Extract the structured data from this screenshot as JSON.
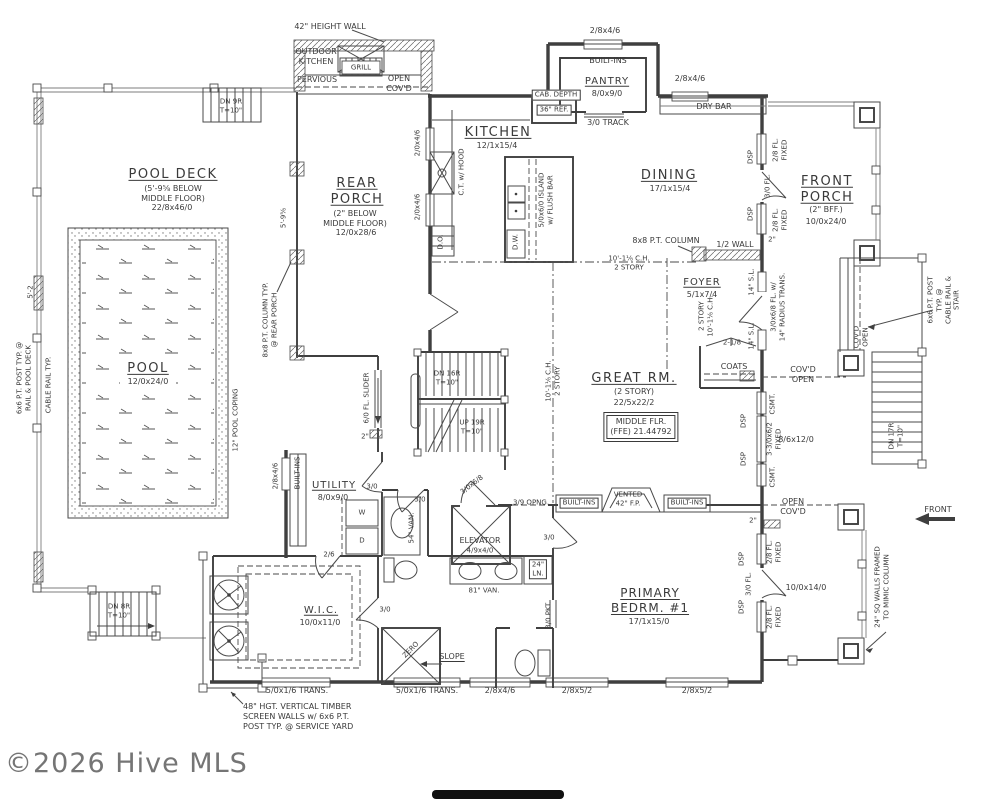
{
  "labels": {
    "dn9r": "DN 9R\nT=10\"",
    "height_wall": "42\" HEIGHT WALL",
    "outdoor_kitchen": "OUTDOOR\nKITCHEN",
    "grill": "GRILL",
    "pervious": "PERVIOUS",
    "open_covd_top": "OPEN\nCOV'D",
    "pantry_win": "2/8x4/6",
    "pantry_builtins": "BUILT-INS",
    "pantry_name": "PANTRY",
    "pantry_dims": "8/0x9/0",
    "drybar_win": "2/8x4/6",
    "dry_bar": "DRY BAR",
    "cab_depth": "CAB. DEPTH",
    "ref36": "36\" REF.",
    "track30": "3/0 TRACK",
    "kitchen_name": "KITCHEN",
    "kitchen_dims": "12/1x15/4",
    "dining_name": "DINING",
    "dining_dims": "17/1x15/4",
    "ct_hood": "C.T. w/ HOOD",
    "do": "D.O.",
    "dw": "D.W.",
    "island": "5/0x6/0 ISLAND\nw/ FLUSH BAR",
    "kitchen_win_a": "2/0x4/6",
    "kitchen_win_b": "2/0x4/6",
    "rear_porch_name": "REAR\nPORCH",
    "rear_porch_sub": "(2\" BELOW\nMIDDLE FLOOR)",
    "rear_porch_dims": "12/0x28/6",
    "dim_5_9": "5'-9⅝",
    "pool_deck_name": "POOL DECK",
    "pool_deck_sub": "(5'-9⅝ BELOW\nMIDDLE FLOOR)",
    "pool_deck_dims": "22/8x46/0",
    "pool_name": "POOL",
    "pool_dims": "12/0x24/0",
    "dim_5_2": "5'-2",
    "post_pool": "6x6 P.T. POST TYP. @\nRAIL & POOL DECK",
    "cable_rail": "CABLE RAIL TYP.",
    "pool_coping": "12\" POOL COPING",
    "column_rear": "8x8 P.T. COLUMN TYP.\n@ REAR PORCH",
    "slider": "6/0 FL. SLIDER",
    "dim2_slider": "2\"",
    "dn16r": "DN 16R\nT=10\"",
    "up19r": "UP 19R\nT=10\"",
    "ch_center": "10'-1⅛ C.H.\n2 STORY",
    "pt_column": "8x8 P.T. COLUMN",
    "ch_dining": "10'-1⅛ C.H.\n2 STORY",
    "half_wall": "1/2 WALL",
    "foyer_name": "FOYER",
    "foyer_dims": "5/1x7/4",
    "foyer_story": "2 STORY\n10'-1⅛ C.H.",
    "front_door": "3/0x6/8 FL. w/\n14\" RADIUS TRANS.",
    "sl14a": "14\" S.L.",
    "sl14b": "14\" S.L.",
    "door218": "2-1/8",
    "coats": "COATS",
    "front_porch_name": "FRONT\nPORCH",
    "front_porch_sub": "(2\" BFF.)",
    "front_porch_dims": "10/0x24/0",
    "fixed28a": "2/8 FL.\nFIXED",
    "fl30a": "3/0 FL.",
    "fixed28b": "2/8 FL.\nFIXED",
    "dspa": "DSP",
    "dspb": "DSP",
    "dim2_porch": "2\"",
    "covd_open_stair": "COV'D\nOPEN",
    "post_stair": "6x6 P.T. POST TYP. @\nCABLE RAIL & STAIR",
    "dn17r": "DN 17R\nT=10\"",
    "covd_open_foyer": "COV'D\nOPEN",
    "great_name": "GREAT RM.",
    "great_sub": "(2 STORY)",
    "great_dims": "22/5x22/2",
    "ffe": "MIDDLE FLR.\n(FFE) 21.44792",
    "csmt_a": "CSMT.",
    "fixed_center": "3-3/0x6/2\nFIXED",
    "csmt_b": "CSMT.",
    "dspc": "DSP",
    "dspd": "DSP",
    "dim_8612": "8/6x12/0",
    "open_covd_right": "OPEN\nCOV'D",
    "dim_10014": "10/0x14/0",
    "mimic": "24\" SQ WALLS FRAMED\nTO MIMIC COLUMN",
    "front_label": "FRONT",
    "util_builtins": "BUILT-INS",
    "util_win": "2/8x4/6",
    "utility_name": "UTILITY",
    "utility_dims": "8/0x9/0",
    "door30_util": "3/0",
    "door30_hall": "3/0",
    "w": "W",
    "d": "D",
    "van54": "54\" VAN.",
    "elev_name": "ELEVATOR",
    "elev_dims": "4/9x4/0",
    "door3068": "3/0x6/8",
    "door26": "2/6",
    "wic_name": "W.I.C.",
    "wic_dims": "10/0x11/0",
    "door30_wic": "3/0",
    "zero": "ZERO",
    "slope": "SLOPE",
    "trans_a": "5/0x1/6 TRANS.",
    "trans_b": "5/0x1/6 TRANS.",
    "win_2846": "2/8x4/6",
    "win_2852a": "2/8x5/2",
    "win_2852b": "2/8x5/2",
    "timber": "48\" HGT. VERTICAL TIMBER\nSCREEN WALLS w/ 6x6 P.T.\nPOST TYP. @ SERVICE YARD",
    "dn8r": "DN 8R\nT=10\"",
    "opng39": "3/9 OPNG.",
    "builtins_l": "BUILT-INS",
    "vented": "VENTED\n42\" F.P.",
    "builtins_r": "BUILT-INS",
    "door30_prim": "3/0",
    "ln24": "24\"\nLN.",
    "pkt30": "3/0 PKT.",
    "primary_name": "PRIMARY\nBEDRM. #1",
    "primary_dims": "17/1x15/0",
    "van81": "81\" VAN.",
    "dim2_right": "2\"",
    "dspe": "DSP",
    "fixed28c": "2/8 FL.\nFIXED",
    "fl30b": "3/0 FL.",
    "dspf": "DSP",
    "fixed28d": "2/8 FL.\nFIXED",
    "watermark": "©2026 Hive MLS"
  }
}
